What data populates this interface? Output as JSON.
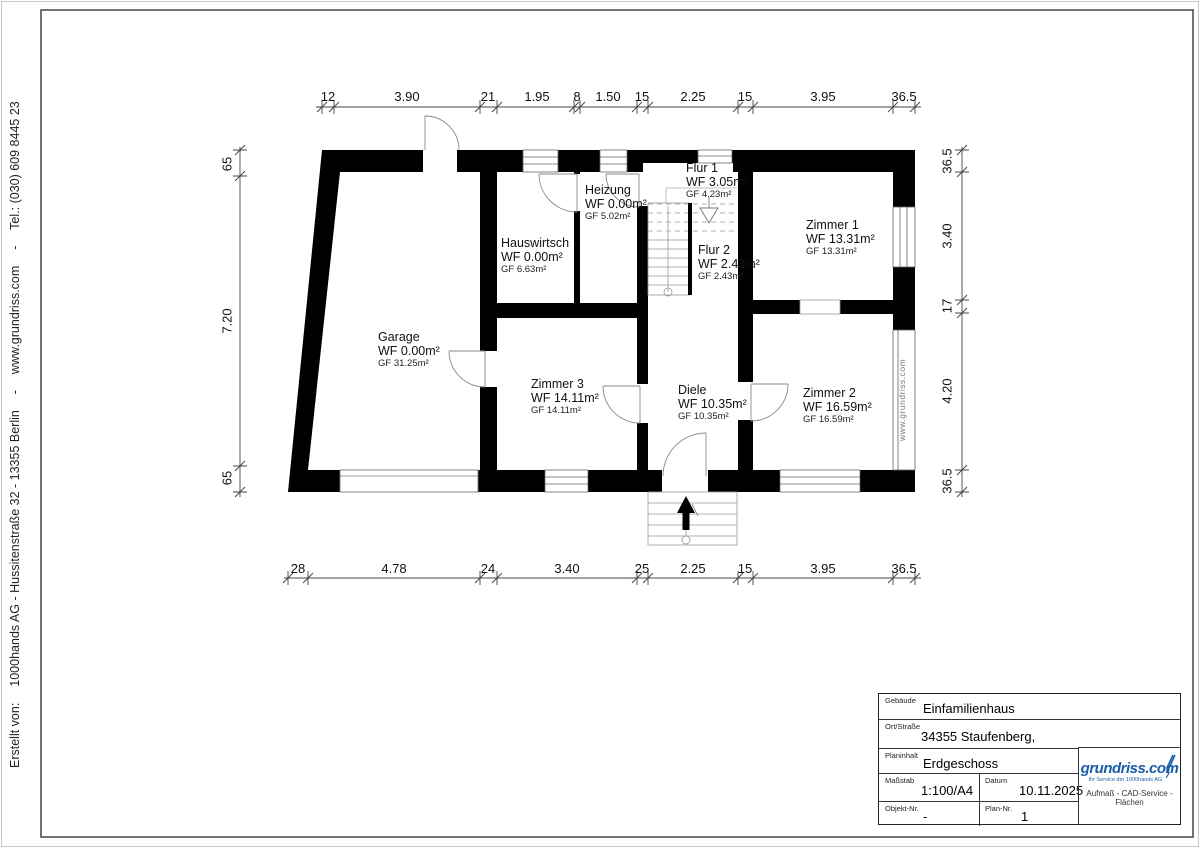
{
  "page": {
    "credit": "Erstellt von:  1000hands AG - Hussitenstraße 32 - 13355 Berlin  -  www.grundriss.com  -  Tel.: (030) 609 8445 23",
    "watermark": "www.grundriss.com"
  },
  "plan": {
    "rooms": [
      {
        "name": "Garage",
        "wf": "WF 0.00m²",
        "gf": "GF 31.25m²"
      },
      {
        "name": "Hauswirtsch",
        "wf": "WF 0.00m²",
        "gf": "GF 6.63m²"
      },
      {
        "name": "Heizung",
        "wf": "WF 0.00m²",
        "gf": "GF 5.02m²"
      },
      {
        "name": "Flur 1",
        "wf": "WF 3.05m²",
        "gf": "GF 4.23m²"
      },
      {
        "name": "Flur 2",
        "wf": "WF 2.43m²",
        "gf": "GF 2.43m²"
      },
      {
        "name": "Zimmer 1",
        "wf": "WF 13.31m²",
        "gf": "GF 13.31m²"
      },
      {
        "name": "Zimmer 2",
        "wf": "WF 16.59m²",
        "gf": "GF 16.59m²"
      },
      {
        "name": "Zimmer 3",
        "wf": "WF 14.11m²",
        "gf": "GF 14.11m²"
      },
      {
        "name": "Diele",
        "wf": "WF 10.35m²",
        "gf": "GF 10.35m²"
      }
    ]
  },
  "dims": {
    "top": [
      "12",
      "3.90",
      "21",
      "1.95",
      "8",
      "1.50",
      "15",
      "2.25",
      "15",
      "3.95",
      "36.5"
    ],
    "bottom": [
      "28",
      "4.78",
      "24",
      "3.40",
      "25",
      "2.25",
      "15",
      "3.95",
      "36.5"
    ],
    "left": [
      "65",
      "7.20",
      "65"
    ],
    "right": [
      "36.5",
      "3.40",
      "17",
      "4.20",
      "36.5"
    ]
  },
  "title_block": {
    "gebaeude_label": "Gebäude",
    "gebaeude_value": "Einfamilienhaus",
    "ort_label": "Ort/Straße",
    "ort_value": "34355 Staufenberg,",
    "planinhalt_label": "Planinhalt",
    "planinhalt_value": "Erdgeschoss",
    "massstab_label": "Maßstab",
    "massstab_value": "1:100/A4",
    "datum_label": "Datum",
    "datum_value": "10.11.2025",
    "objekt_label": "Objekt-Nr.",
    "objekt_value": "-",
    "plannr_label": "Plan-Nr.",
    "plannr_value": "1"
  },
  "logo": {
    "brand": "grundriss.com",
    "tagline": "Ihr Service der 1000hands AG",
    "services": "Aufmaß - CAD-Service - Flächen",
    "color": "#1b5fa8"
  }
}
